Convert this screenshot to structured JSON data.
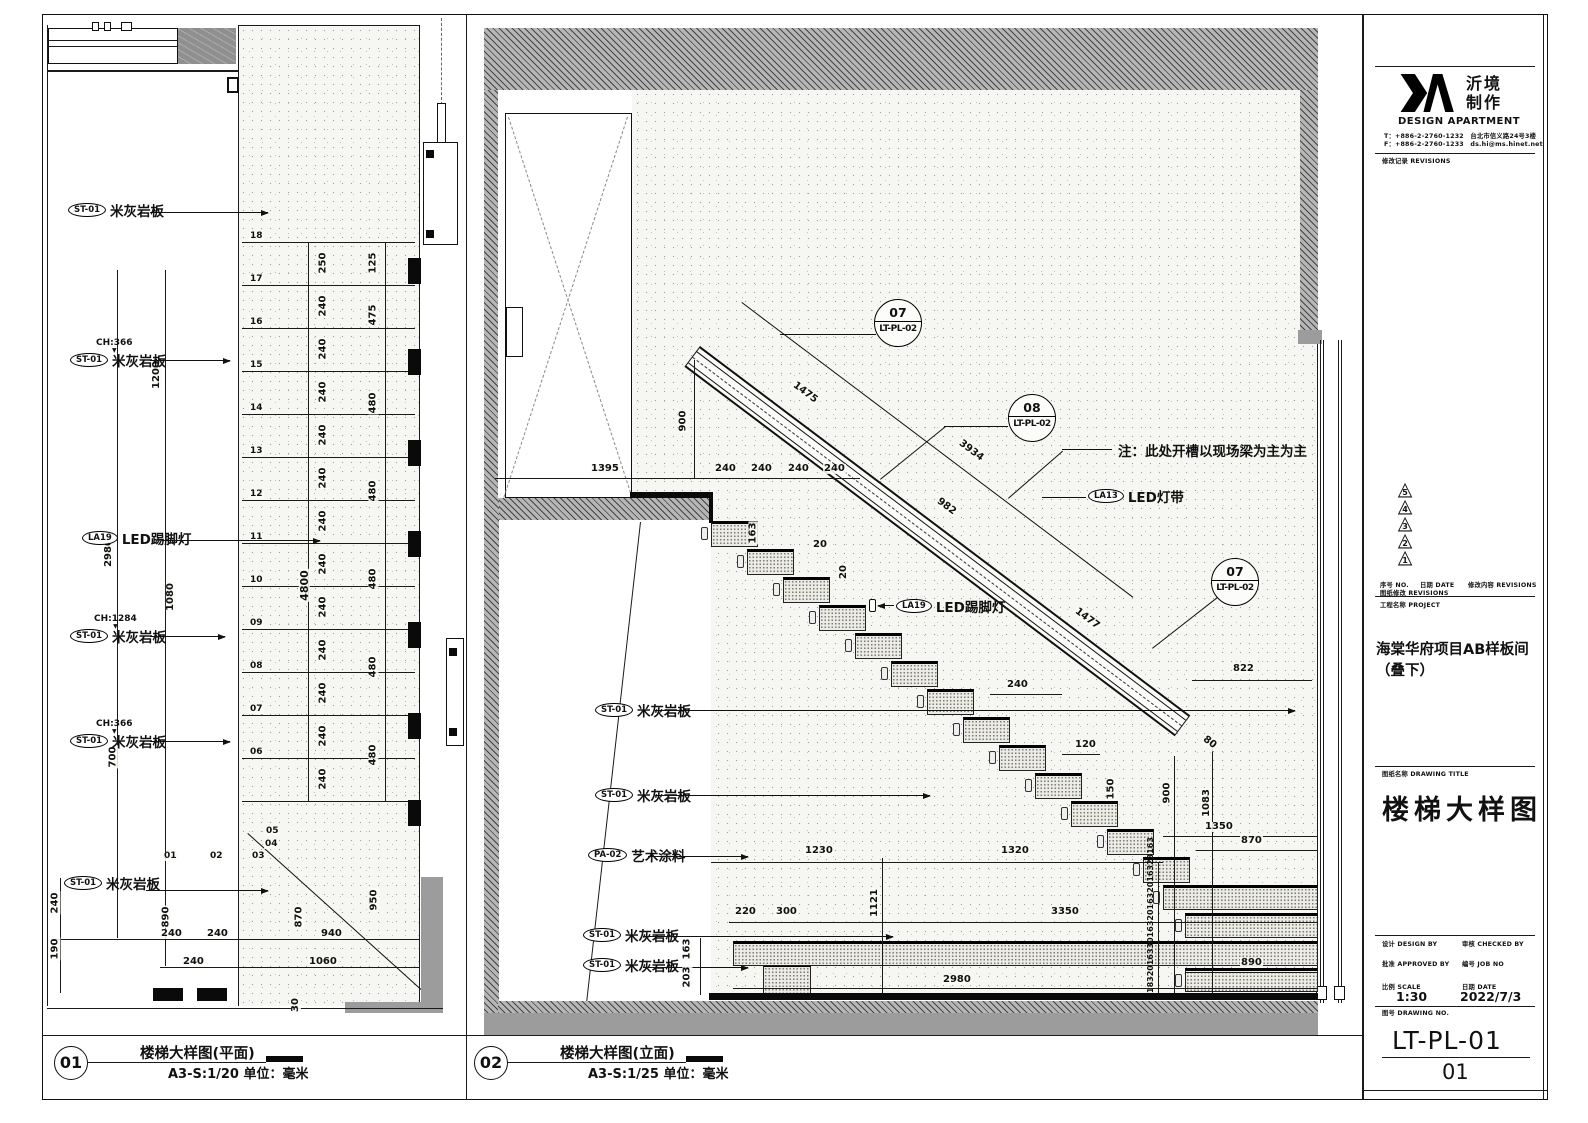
{
  "captions": [
    {
      "num": "01",
      "title": "楼梯大样图(平面)",
      "scale": "A3-S:1/20 单位：毫米"
    },
    {
      "num": "02",
      "title": "楼梯大样图(立面)",
      "scale": "A3-S:1/25 单位：毫米"
    }
  ],
  "titleblock": {
    "logo_cn1": "沂境",
    "logo_cn2": "制作",
    "logo_en": "DESIGN APARTMENT",
    "tel": "T：+886-2-2760-1232　台北市信义路24号3楼",
    "fax": "F：+886-2-2760-1233　ds.hi@ms.hinet.net",
    "revisions_header": "修改记录 REVISIONS",
    "rev_triangles": [
      "5",
      "4",
      "3",
      "2",
      "1"
    ],
    "rev_no": "序号 NO.",
    "rev_date": "日期 DATE",
    "rev_content": "修改内容 REVISIONS",
    "rev_note": "图纸修改 REVISIONS",
    "project_label": "工程名称 PROJECT",
    "project_name": "海棠华府项目AB样板间（叠下）",
    "title_label": "图纸名称 DRAWING TITLE",
    "drawing_title": "楼梯大样图",
    "design_by": "设计 DESIGN BY",
    "checked_by": "审核 CHECKED BY",
    "approved_by": "批准 APPROVED BY",
    "job_no": "编号 JOB NO",
    "scale_label": "比例 SCALE",
    "scale_value": "1:30",
    "date_label": "日期 DATE",
    "date_value": "2022/7/3",
    "dwg_label": "图号 DRAWING NO.",
    "dwg_no": "LT-PL-01",
    "sheet_no": "01"
  },
  "plan": {
    "materials": [
      {
        "tag": "ST-01",
        "name": "米灰岩板",
        "ch": ""
      },
      {
        "tag": "ST-01",
        "name": "米灰岩板",
        "ch": "CH:366"
      },
      {
        "tag": "LA19",
        "name": "LED踢脚灯",
        "ch": ""
      },
      {
        "tag": "ST-01",
        "name": "米灰岩板",
        "ch": "CH:1284"
      },
      {
        "tag": "ST-01",
        "name": "米灰岩板",
        "ch": "CH:366"
      },
      {
        "tag": "ST-01",
        "name": "米灰岩板",
        "ch": ""
      }
    ],
    "tread_numbers": [
      "18",
      "17",
      "16",
      "15",
      "14",
      "13",
      "12",
      "11",
      "10",
      "09",
      "08",
      "07",
      "06"
    ],
    "tread_depths": [
      "250",
      "240",
      "240",
      "240",
      "240",
      "240",
      "240",
      "240",
      "240",
      "240",
      "240",
      "240",
      "240"
    ],
    "right_dims": [
      "125",
      "475",
      "480",
      "480",
      "480",
      "480",
      "480"
    ],
    "run_dim": "4800",
    "v_dims": [
      "1200",
      "2980",
      "1080",
      "700",
      "890",
      "240",
      "190",
      "870",
      "950",
      "30"
    ],
    "h_dims": [
      "240",
      "240",
      "940",
      "240",
      "1060"
    ],
    "bottom_steps": [
      "01",
      "02",
      "03",
      "04",
      "05"
    ]
  },
  "elevation": {
    "note": "注：此处开槽以现场梁为主为主",
    "callouts": [
      {
        "num": "07",
        "ref": "LT-PL-02"
      },
      {
        "num": "08",
        "ref": "LT-PL-02"
      },
      {
        "num": "07",
        "ref": "LT-PL-02"
      }
    ],
    "materials": [
      {
        "tag": "ST-01",
        "name": "米灰岩板"
      },
      {
        "tag": "ST-01",
        "name": "米灰岩板"
      },
      {
        "tag": "PA-02",
        "name": "艺术涂料"
      },
      {
        "tag": "ST-01",
        "name": "米灰岩板"
      },
      {
        "tag": "ST-01",
        "name": "米灰岩板"
      },
      {
        "tag": "LA19",
        "name": "LED踢脚灯"
      },
      {
        "tag": "LA13",
        "name": "LED灯带"
      }
    ],
    "rail_dims": [
      "1475",
      "3934",
      "982",
      "1477"
    ],
    "top_dims": [
      "240",
      "240",
      "240",
      "240"
    ],
    "d": {
      "w1395": "1395",
      "h900": "900",
      "r163": "163",
      "r20a": "20",
      "r20b": "20",
      "w822": "822",
      "r80": "80",
      "w240": "240",
      "w120": "120",
      "r150": "150",
      "h900b": "900",
      "h1083": "1083",
      "w1350": "1350",
      "w870": "870",
      "w1230": "1230",
      "w1320": "1320",
      "w220": "220",
      "w300": "300",
      "h1121": "1121",
      "w3350": "3350",
      "w2980": "2980",
      "w890": "890",
      "r163b": "163",
      "r203": "203"
    },
    "riser_stack": [
      "183",
      "20",
      "163",
      "30",
      "163",
      "20",
      "163",
      "20",
      "163",
      "23",
      "163"
    ]
  }
}
